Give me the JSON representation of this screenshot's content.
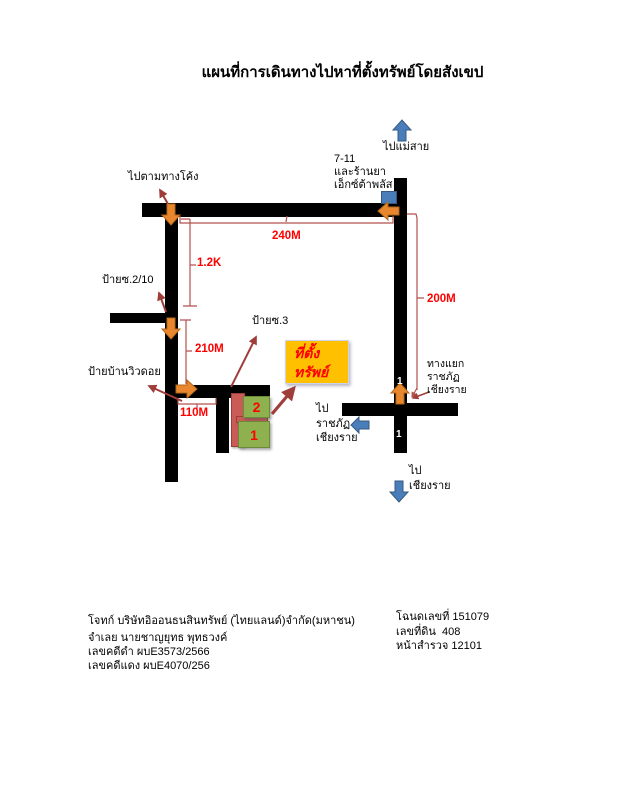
{
  "title": "แผนที่การเดินทางไปหาที่ตั้งทรัพย์โดยสังเขป",
  "map": {
    "directions": {
      "to_mae_sai": "ไปแม่สาย",
      "follow_curve": "ไปตามทางโค้ง",
      "to_ratchaphat": "ไป\nราชภัฏ\nเชียงราย",
      "to_chiang_rai": "ไป\nเชียงราย"
    },
    "landmarks": {
      "seven_eleven": "7-11\nและร้านยา\nเอ็กซ์ต้าพลัส",
      "sign_soi_2_10": "ป้ายซ.2/10",
      "sign_soi_3": "ป้ายซ.3",
      "sign_baan_view_doi": "ป้ายบ้านวิวดอย",
      "junction": "ทางแยก\nราชภัฏ\nเชียงราย",
      "property": "ที่ตั้ง\nทรัพย์"
    },
    "distances": {
      "d240": "240M",
      "d1_2k": "1.2K",
      "d210": "210M",
      "d110": "110M",
      "d200": "200M"
    },
    "plots": {
      "plot2": "2",
      "plot1": "1"
    },
    "route_numbers": {
      "upper": "1",
      "lower": "1"
    }
  },
  "footer": {
    "left": {
      "plaintiff": "โจทก์ บริษัทอิออนธนสินทรัพย์ (ไทยแลนด์)จำกัด(มหาชน)",
      "defendant": "จำเลย นายชาญยุทธ พุทธวงค์",
      "black_case": "เลขคดีดำ ผบE3573/2566",
      "red_case": "เลขคดีแดง ผบE4070/256"
    },
    "right": {
      "deed_no": "โฉนดเลขที่ 151079",
      "land_no": "เลขที่ดิน  408",
      "survey_page": "หน้าสำรวจ 12101"
    }
  },
  "colors": {
    "road": "#000000",
    "orange_arrow": "#e8872e",
    "blue_arrow": "#4a7ebb",
    "pointer_red": "#9e3d39",
    "measure_red": "#b3524d",
    "label_red": "#ff0000",
    "property_bg": "#ffc000",
    "plot_green": "#8fb04e",
    "plot_pink": "#ca5c58"
  }
}
